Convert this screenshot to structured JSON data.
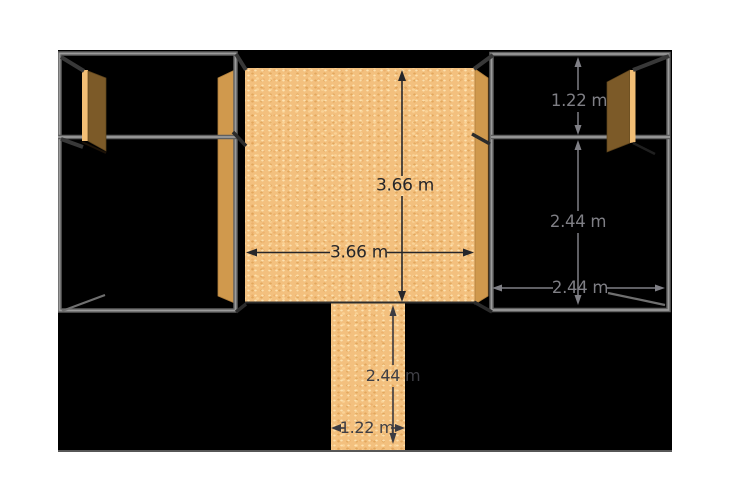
{
  "scene": {
    "type": "3d-model-dimensioned-view",
    "colors": {
      "page_background": "#ffffff",
      "canvas_background": "#000000",
      "frame_gray": "#9b9b9b",
      "plywood_tan": "#f3c07e",
      "panel_tan": "#d0994d",
      "door_brown": "#7c5a28",
      "door_light": "#f2be75",
      "dimension_dark": "#26262a",
      "dimension_gray": "#7f7f85"
    }
  },
  "dimensions": {
    "wall": {
      "height": "3.66 m",
      "width": "3.66 m"
    },
    "right_room": {
      "upper_height": "1.22 m",
      "lower_height": "2.44 m",
      "width": "2.44 m"
    },
    "lower_strip": {
      "height": "2.44 m",
      "width": "1.22 m"
    }
  }
}
